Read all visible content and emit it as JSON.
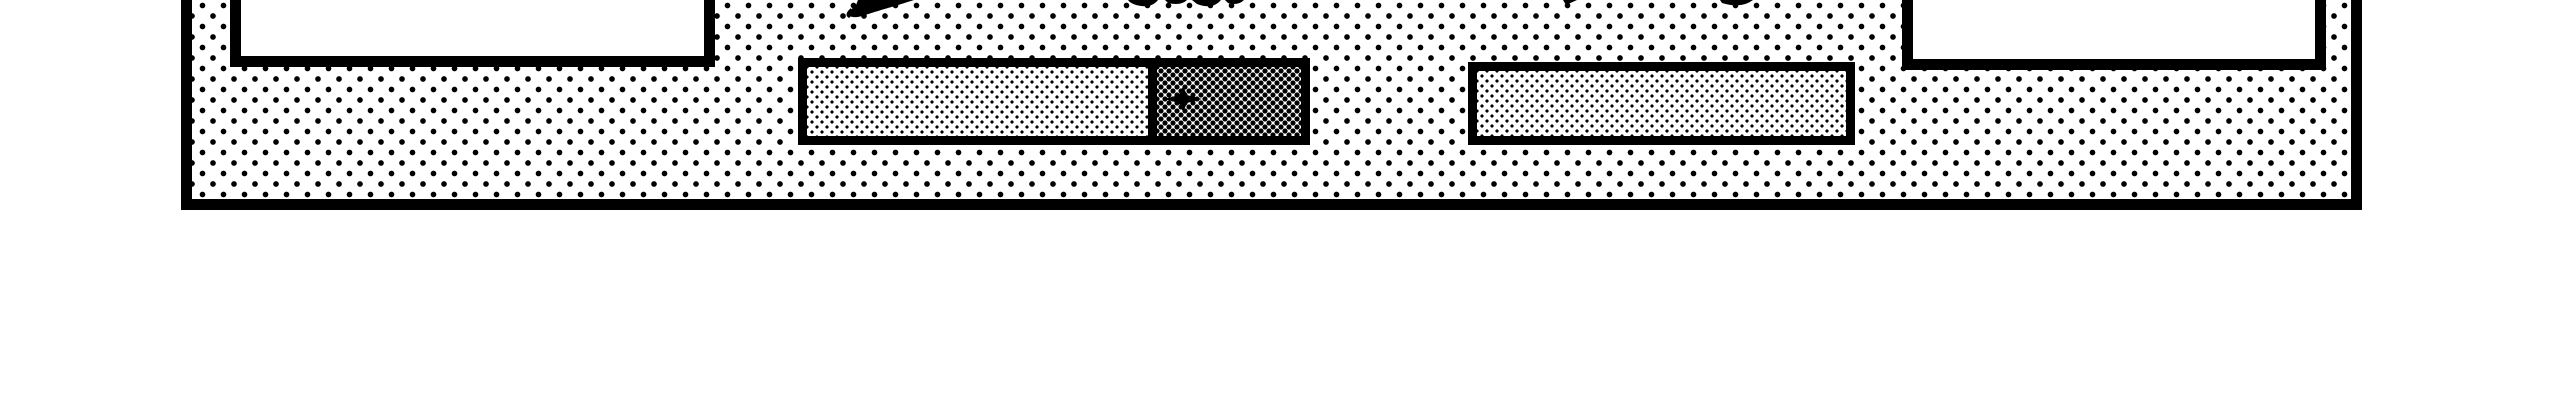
{
  "palette": {
    "ink": "#000000",
    "paper": "#ffffff"
  },
  "panel": {
    "style": "monochrome-dialog",
    "background_pattern": "halftone-dots-25pct",
    "border": "thick-black",
    "cut_off_at_top": true
  },
  "buttons": {
    "left": {
      "label": "",
      "note_visible_text": ""
    },
    "right": {
      "label": "",
      "note_visible_text": ""
    }
  },
  "progress_bar": {
    "segments": 2,
    "filled_pattern": "fine-halftone-light",
    "remaining_pattern": "dense-halftone-dark",
    "filled_ratio": 0.69,
    "cursor": "crosshair"
  },
  "secondary_bar": {
    "segments": 1,
    "fill_pattern": "fine-halftone-light",
    "filled_ratio": 1.0
  },
  "icons": {
    "crosshair": "crosshair-cursor-icon",
    "fragments": "cutoff-artwork-fragments"
  }
}
